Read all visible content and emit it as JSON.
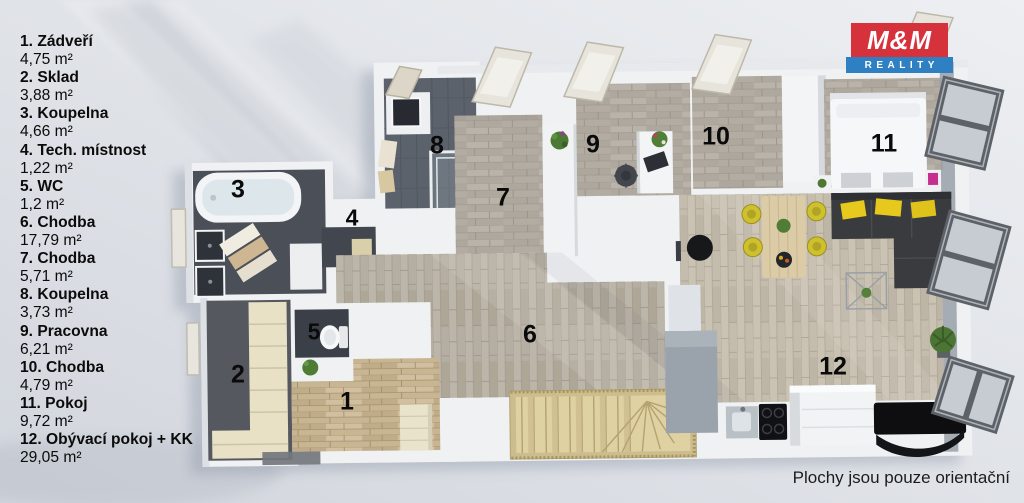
{
  "legend": {
    "items": [
      {
        "number": "1",
        "label": "1. Zádveří",
        "name": "Zádveří",
        "area": "4,75 m²"
      },
      {
        "number": "2",
        "label": "2. Sklad",
        "name": "Sklad",
        "area": "3,88 m²"
      },
      {
        "number": "3",
        "label": "3. Koupelna",
        "name": "Koupelna",
        "area": "4,66 m²"
      },
      {
        "number": "4",
        "label": "4. Tech. místnost",
        "name": "Tech. místnost",
        "area": "1,22 m²"
      },
      {
        "number": "5",
        "label": "5. WC",
        "name": "WC",
        "area": "1,2 m²"
      },
      {
        "number": "6",
        "label": "6. Chodba",
        "name": "Chodba",
        "area": "17,79 m²"
      },
      {
        "number": "7",
        "label": "7. Chodba",
        "name": "Chodba",
        "area": "5,71 m²"
      },
      {
        "number": "8",
        "label": "8. Koupelna",
        "name": "Koupelna",
        "area": "3,73 m²"
      },
      {
        "number": "9",
        "label": "9. Pracovna",
        "name": "Pracovna",
        "area": "6,21 m²"
      },
      {
        "number": "10",
        "label": "10. Chodba",
        "name": "Chodba",
        "area": "4,79 m²"
      },
      {
        "number": "11",
        "label": "11. Pokoj",
        "name": "Pokoj",
        "area": "9,72 m²"
      },
      {
        "number": "12",
        "label": "12. Obývací pokoj + KK",
        "name": "Obývací pokoj + KK",
        "area": "29,05 m²"
      }
    ]
  },
  "logo": {
    "title": "M&M",
    "subtitle": "REALITY",
    "red": "#d6323b",
    "blue": "#2e80c2"
  },
  "footer": {
    "disclaimer": "Plochy jsou pouze orientační"
  },
  "palette": {
    "wall": "#f0f1f3",
    "floor_plank_gray": "#b2aca2",
    "floor_plank_warm": "#b5aea2",
    "floor_plank_beige": "#c3bcae",
    "floor_plank_tan": "#c8b592",
    "floor_tile_dark": "#5b626c",
    "stairs_wood": "#d9caa0",
    "sofa_dark": "#3a3b3e",
    "accent_yellow": "#e3c71e",
    "chair_yellow": "#cfc12e"
  }
}
